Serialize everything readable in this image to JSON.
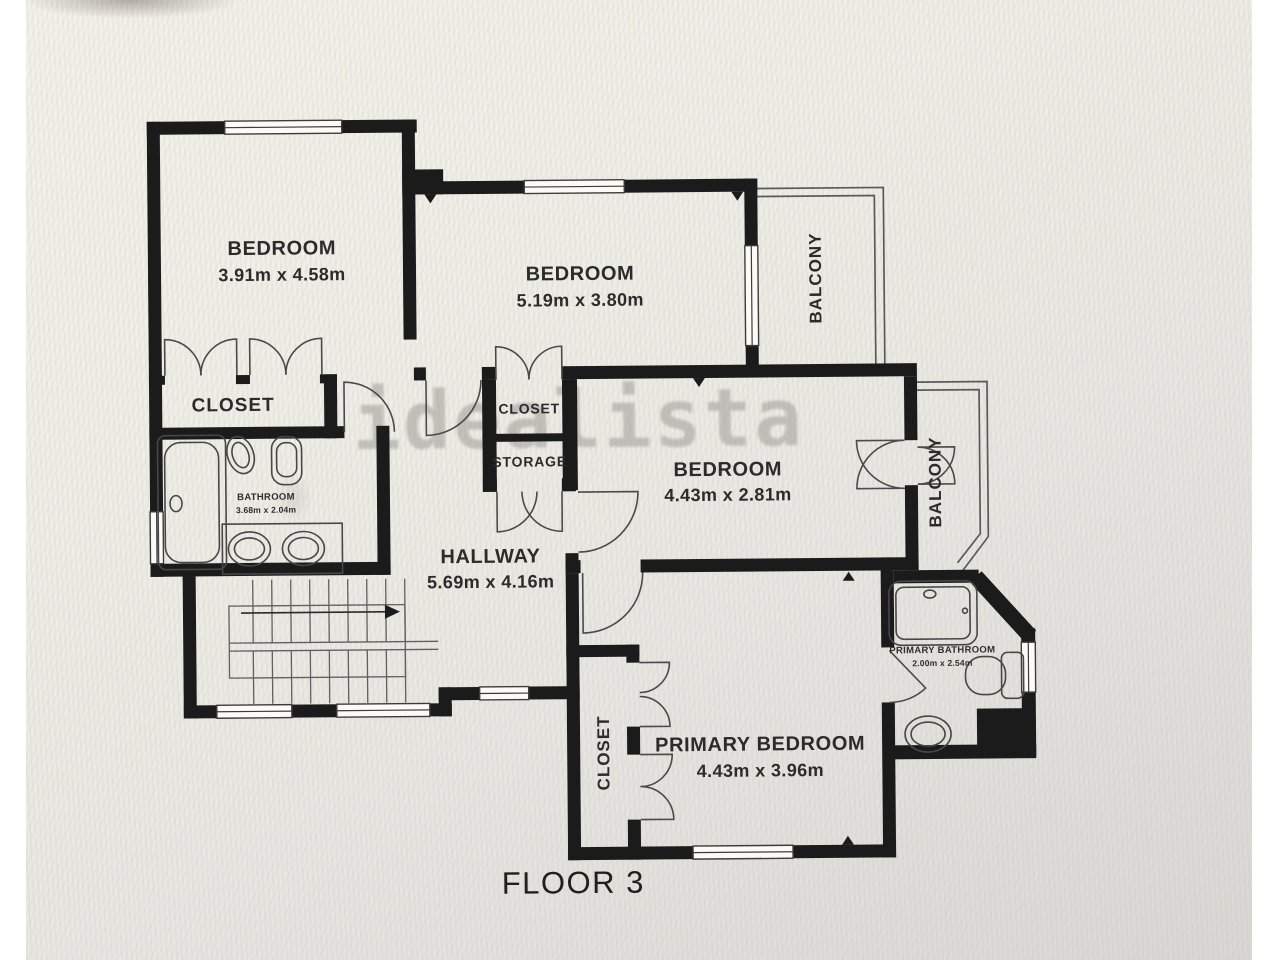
{
  "plan": {
    "caption": "FLOOR 3",
    "watermark": "idealista",
    "rooms": {
      "bedroom_top_left": {
        "name": "BEDROOM",
        "dims": "3.91m x 4.58m"
      },
      "bedroom_top_middle": {
        "name": "BEDROOM",
        "dims": "5.19m x 3.80m"
      },
      "bedroom_middle_right": {
        "name": "BEDROOM",
        "dims": "4.43m x 2.81m"
      },
      "primary_bedroom": {
        "name": "PRIMARY BEDROOM",
        "dims": "4.43m x 3.96m"
      },
      "hallway": {
        "name": "HALLWAY",
        "dims": "5.69m x 4.16m"
      },
      "bathroom": {
        "name": "BATHROOM",
        "dims": "3.68m x 2.04m"
      },
      "primary_bathroom": {
        "name": "PRIMARY BATHROOM",
        "dims": "2.00m x 2.54m"
      },
      "closet_left": {
        "name": "CLOSET"
      },
      "closet_center": {
        "name": "CLOSET"
      },
      "storage": {
        "name": "STORAGE"
      },
      "closet_primary": {
        "name": "CLOSET"
      },
      "balcony_top": {
        "name": "BALCONY"
      },
      "balcony_right": {
        "name": "BALCONY"
      }
    },
    "colors": {
      "wall": "#1b1b1b",
      "thin_line": "#5a5a5a",
      "label_text": "#2b2b2b",
      "watermark_gray": "#9b9892",
      "background": "#eceae5"
    }
  }
}
